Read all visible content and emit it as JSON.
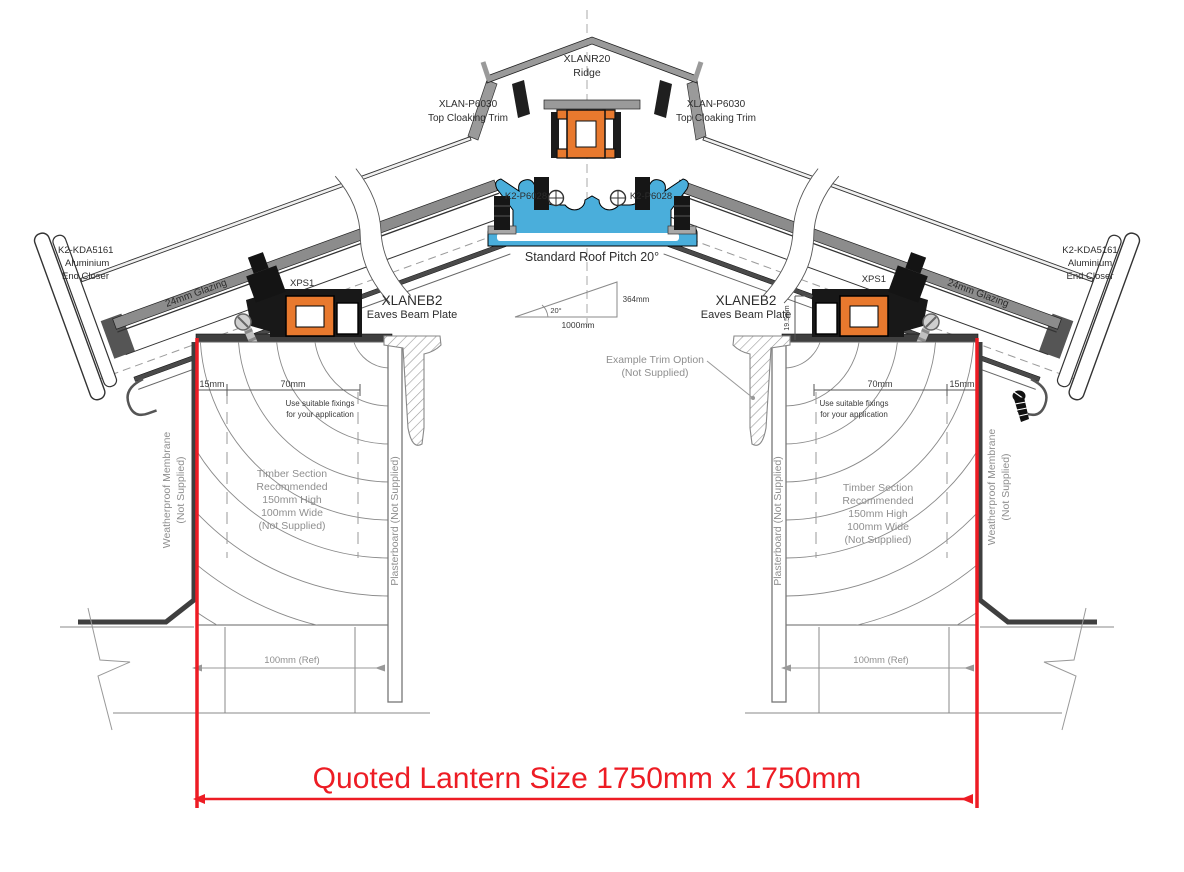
{
  "labels": {
    "ridge_code": "XLANR20",
    "ridge_name": "Ridge",
    "top_trim_code": "XLAN-P6030",
    "top_trim_name": "Top Cloaking Trim",
    "glazing_bar_code": "K2-P6028",
    "roof_pitch": "Standard Roof Pitch 20°",
    "pitch_angle": "20°",
    "pitch_rise": "364mm",
    "pitch_run": "1000mm",
    "eaves_code": "XLANEB2",
    "eaves_name": "Eaves Beam Plate",
    "xps": "XPS1",
    "end_closer_code": "K2-KDA5161",
    "end_closer_l1": "Aluminium",
    "end_closer_l2": "End Closer",
    "glazing": "24mm Glazing",
    "dim_15": "15mm",
    "dim_70": "70mm",
    "dim_beam_height": "19.5mm",
    "fixings_l1": "Use suitable fixings",
    "fixings_l2": "for your application",
    "timber_l1": "Timber Section",
    "timber_l2": "Recommended",
    "timber_l3": "150mm High",
    "timber_l4": "100mm Wide",
    "timber_l5": "(Not Supplied)",
    "membrane_l1": "Weatherproof Membrane",
    "membrane_l2": "(Not Supplied)",
    "plasterboard": "Plasterboard (Not Supplied)",
    "trim_option_l1": "Example  Trim Option",
    "trim_option_l2": "(Not Supplied)",
    "wall_ref": "100mm (Ref)",
    "quoted_size": "Quoted Lantern Size 1750mm x 1750mm"
  },
  "colors": {
    "accent_orange": "#e8792e",
    "accent_blue": "#4aaedb",
    "dimension_red": "#ed1c24",
    "line_dark": "#2d2d2d",
    "line_gray": "#8f8f8f"
  }
}
